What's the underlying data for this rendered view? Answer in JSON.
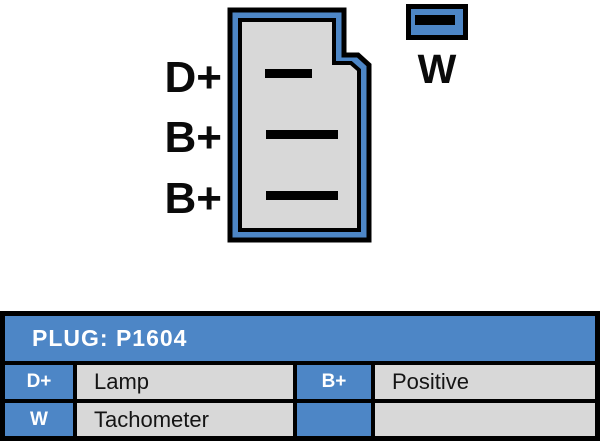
{
  "diagram": {
    "pin_labels": [
      "D+",
      "B+",
      "B+"
    ],
    "w_label": "W"
  },
  "table": {
    "title": "PLUG: P1604",
    "rows": [
      {
        "cells": [
          {
            "terminal": "D+",
            "description": "Lamp"
          },
          {
            "terminal": "B+",
            "description": "Positive"
          }
        ]
      },
      {
        "cells": [
          {
            "terminal": "W",
            "description": "Tachometer"
          },
          {
            "terminal": "",
            "description": ""
          }
        ]
      }
    ]
  },
  "colors": {
    "connector_blue": "#4d86c6",
    "cavity_gray": "#d8d8d8",
    "border_black": "#000000",
    "text_white": "#ffffff"
  }
}
